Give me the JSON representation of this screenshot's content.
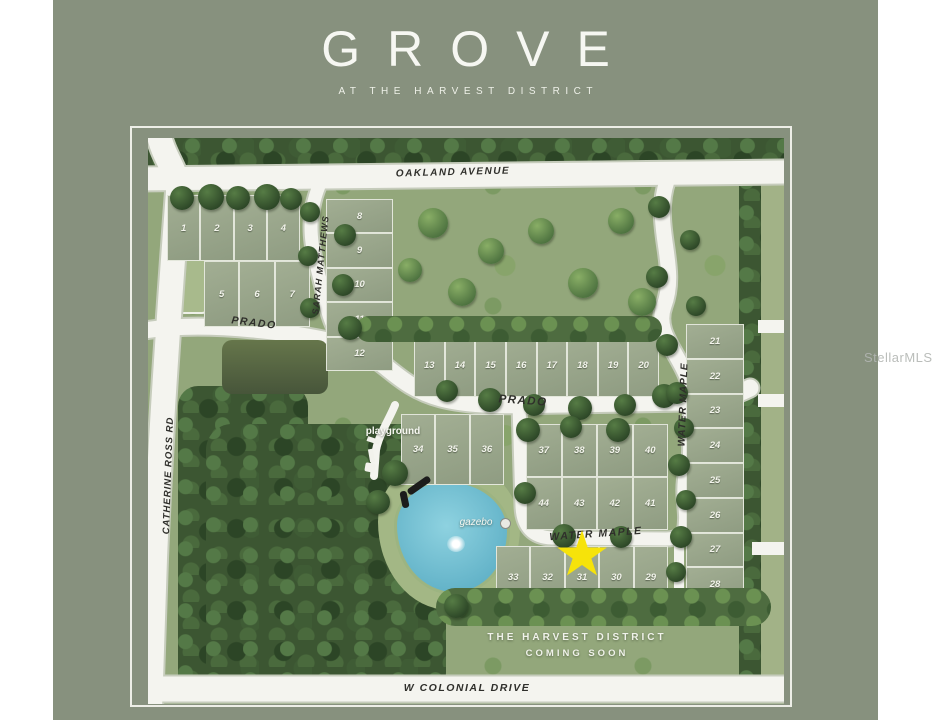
{
  "header": {
    "title": "GROVE",
    "subtitle": "AT THE HARVEST DISTRICT"
  },
  "watermark": "StellarMLS",
  "map": {
    "streets": {
      "oakland": "OAKLAND AVENUE",
      "catherine_ross": "CATHERINE ROSS RD",
      "sarah_matthews": "SARAH MATTHEWS",
      "prado": "PRADO",
      "water_maple": "WATER MAPLE",
      "colonial": "W COLONIAL DRIVE"
    },
    "pois": {
      "playground": "playground",
      "gazebo": "gazebo"
    },
    "banner": {
      "line1": "THE HARVEST DISTRICT",
      "line2": "COMING SOON"
    },
    "lots": {
      "a1": [
        "1",
        "2",
        "3",
        "4"
      ],
      "a2": [
        "5",
        "6",
        "7"
      ],
      "b": [
        "8",
        "9",
        "10",
        "11",
        "12"
      ],
      "c": [
        "13",
        "14",
        "15",
        "16",
        "17",
        "18",
        "19",
        "20"
      ],
      "d": [
        "21",
        "22",
        "23",
        "24",
        "25",
        "26",
        "27",
        "28"
      ],
      "e": [
        "34",
        "35",
        "36"
      ],
      "f": [
        "37",
        "38",
        "39",
        "40",
        "44",
        "43",
        "42",
        "41"
      ],
      "g": [
        "33",
        "32",
        "31",
        "30",
        "29"
      ]
    },
    "colors": {
      "background": "#87917e",
      "road": "#f4f4ef",
      "forest": "#3c5632",
      "field": "#93a77b",
      "lot_pad": "#99a58a",
      "pond": "#79c3d6",
      "star": "#f6e30a"
    }
  }
}
